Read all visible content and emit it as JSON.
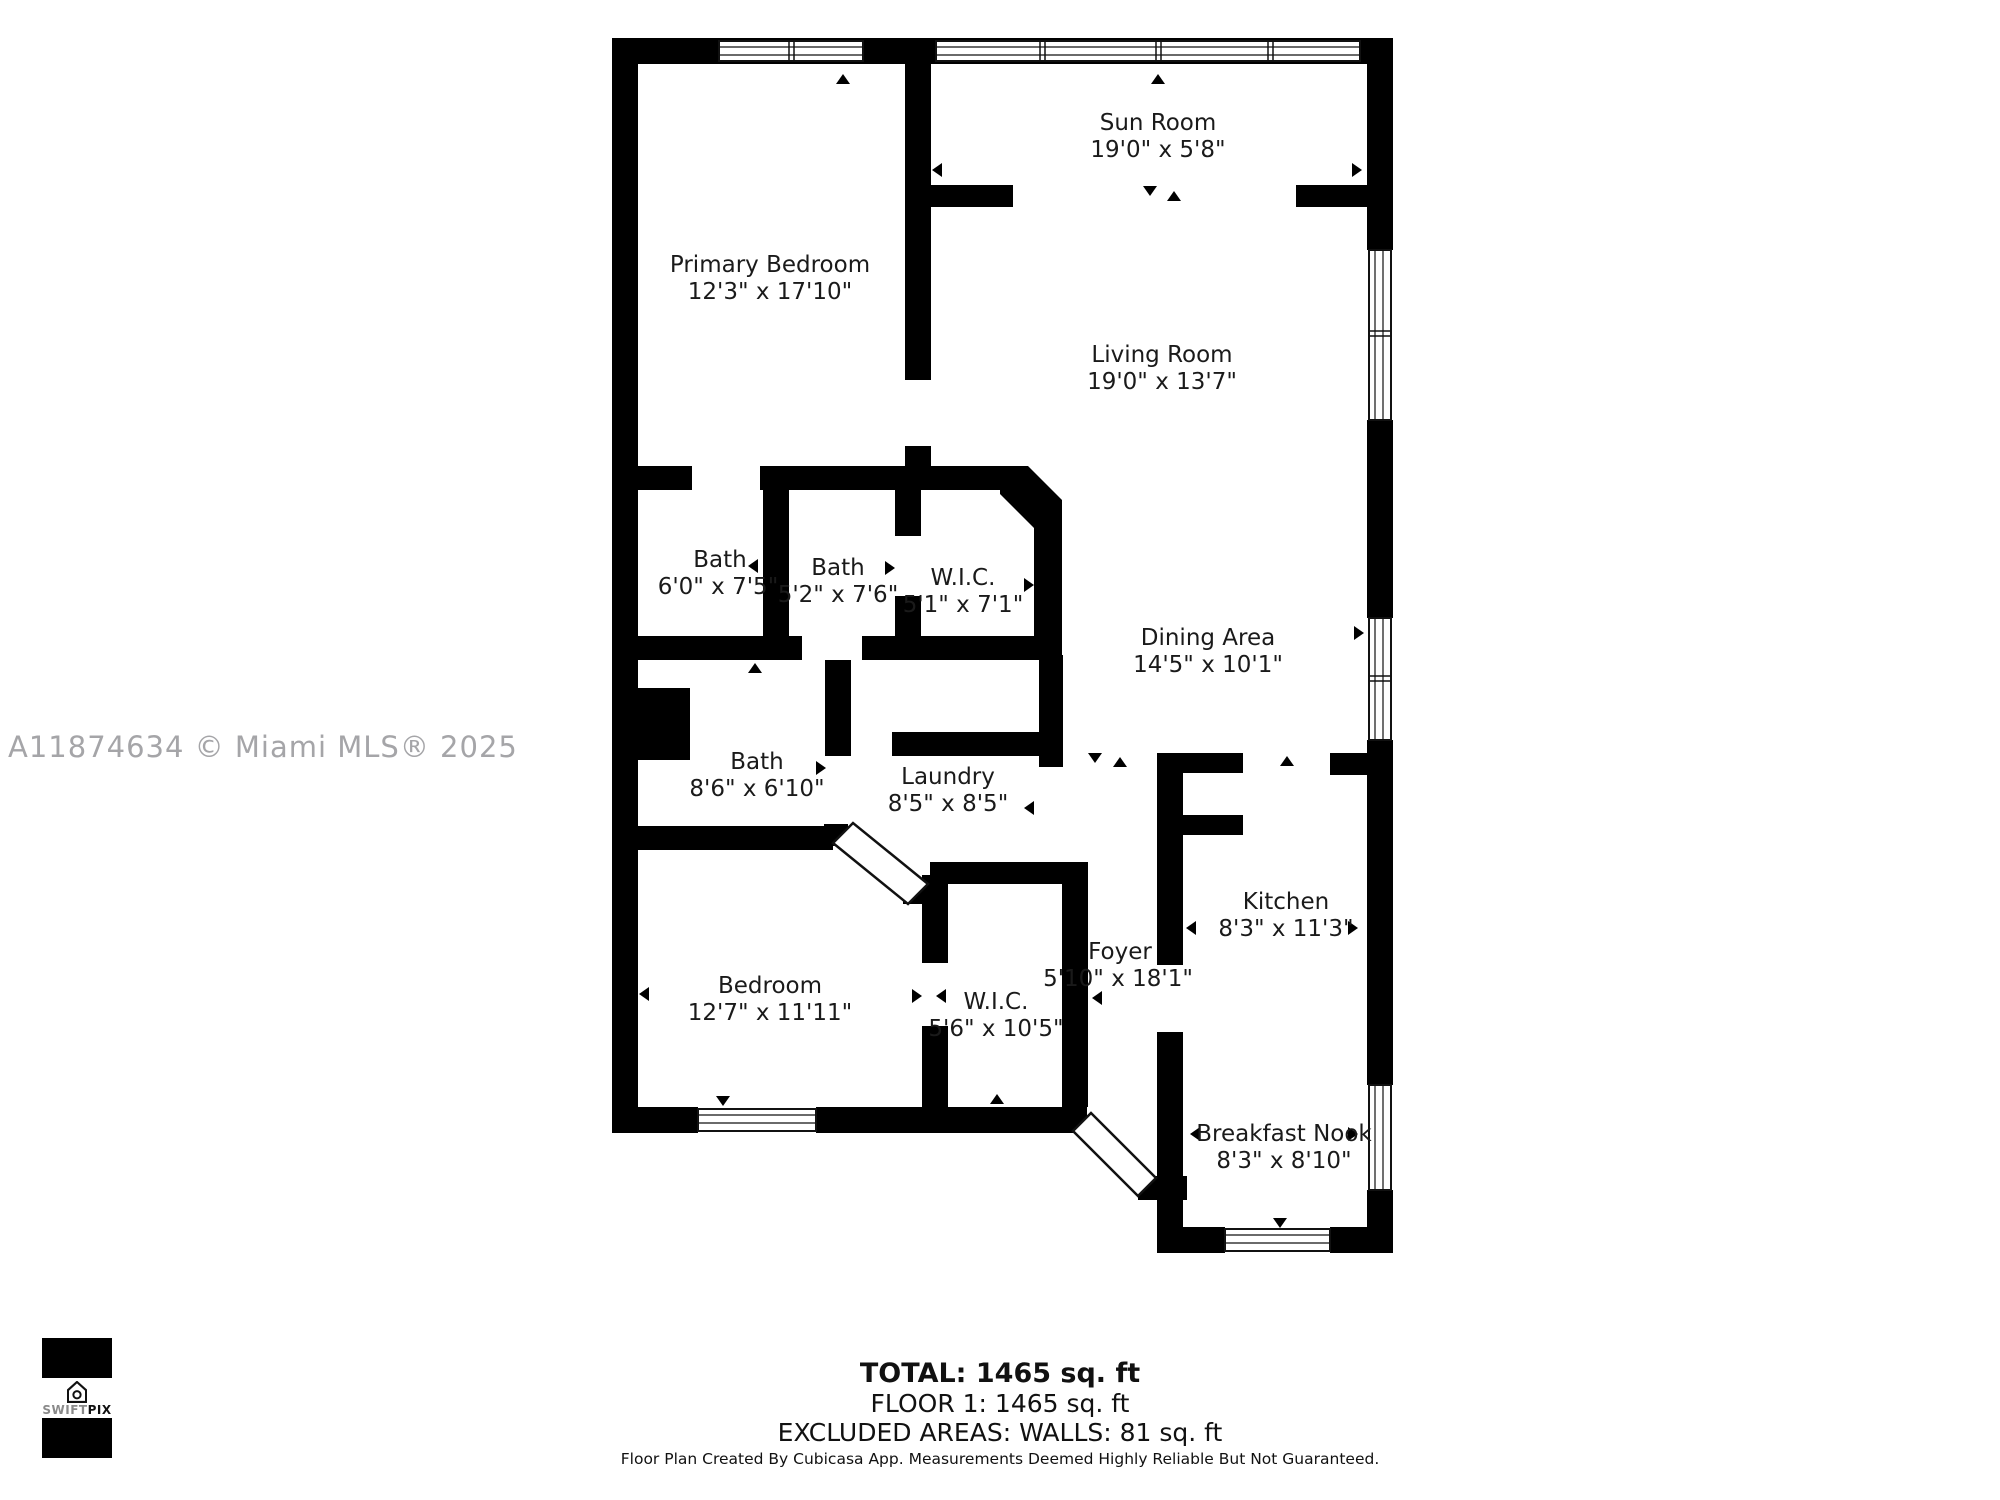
{
  "watermark": {
    "text": "A11874634 © Miami MLS® 2025"
  },
  "rooms": [
    {
      "name": "Sun Room",
      "dims": "19'0\" x 5'8\""
    },
    {
      "name": "Primary Bedroom",
      "dims": "12'3\" x 17'10\""
    },
    {
      "name": "Living Room",
      "dims": "19'0\" x 13'7\""
    },
    {
      "name": "Bath",
      "dims": "6'0\" x 7'5\""
    },
    {
      "name": "Bath",
      "dims": "5'2\" x 7'6\""
    },
    {
      "name": "W.I.C.",
      "dims": "5'1\" x 7'1\""
    },
    {
      "name": "Dining Area",
      "dims": "14'5\" x 10'1\""
    },
    {
      "name": "Bath",
      "dims": "8'6\" x 6'10\""
    },
    {
      "name": "Laundry",
      "dims": "8'5\" x 8'5\""
    },
    {
      "name": "Kitchen",
      "dims": "8'3\" x 11'3\""
    },
    {
      "name": "Bedroom",
      "dims": "12'7\" x 11'11\""
    },
    {
      "name": "W.I.C.",
      "dims": "5'6\" x 10'5\""
    },
    {
      "name": "Foyer",
      "dims": "5'10\" x 18'1\""
    },
    {
      "name": "Breakfast Nook",
      "dims": "8'3\" x 8'10\""
    }
  ],
  "summary": {
    "total": "TOTAL: 1465 sq. ft",
    "floor1": "FLOOR 1: 1465 sq. ft",
    "excluded": "EXCLUDED AREAS: WALLS: 81 sq. ft"
  },
  "footer": {
    "disclaimer": "Floor Plan Created By Cubicasa App. Measurements Deemed Highly Reliable But Not Guaranteed."
  },
  "logo": {
    "swift": "SWIFT",
    "pix": "PIX"
  },
  "colors": {
    "wall": "#000000",
    "background": "#ffffff",
    "watermark": "#a5a5a8",
    "label": "#1a1a1a"
  }
}
